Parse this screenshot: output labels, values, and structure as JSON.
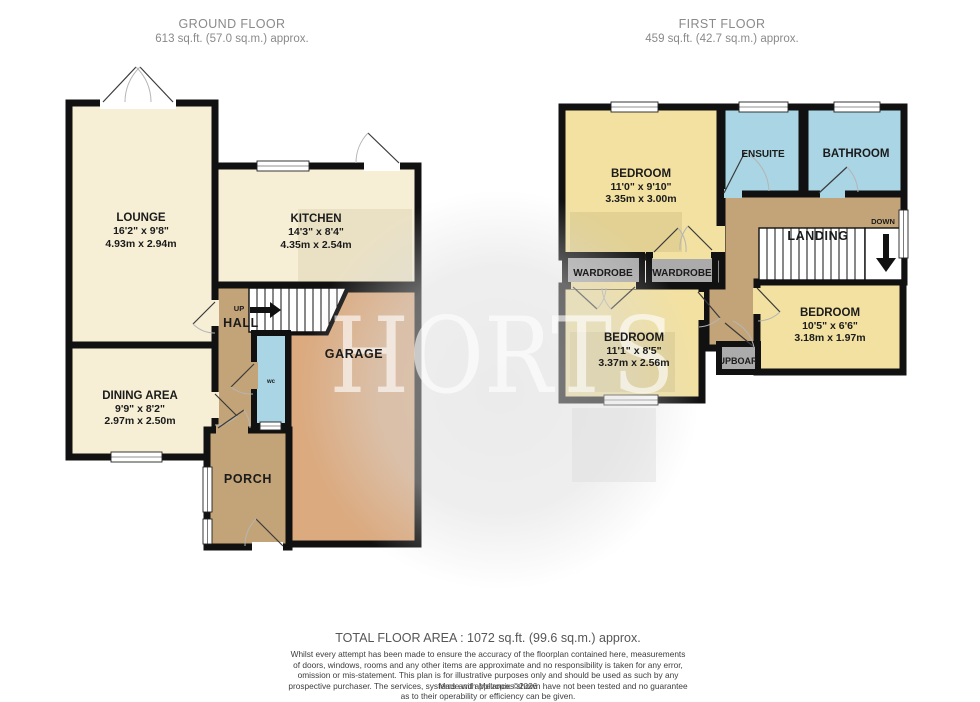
{
  "header": {
    "ground": {
      "title": "GROUND FLOOR",
      "area": "613 sq.ft. (57.0 sq.m.) approx."
    },
    "first": {
      "title": "FIRST FLOOR",
      "area": "459 sq.ft. (42.7 sq.m.) approx."
    }
  },
  "watermark": {
    "text": "HORTS"
  },
  "ground_floor": {
    "lounge": {
      "name": "LOUNGE",
      "dims_ft": "16'2\" x 9'8\"",
      "dims_m": "4.93m x 2.94m"
    },
    "kitchen": {
      "name": "KITCHEN",
      "dims_ft": "14'3\" x 8'4\"",
      "dims_m": "4.35m x 2.54m"
    },
    "dining": {
      "name": "DINING AREA",
      "dims_ft": "9'9\" x 8'2\"",
      "dims_m": "2.97m x 2.50m"
    },
    "hall": {
      "name": "HALL",
      "up": "UP"
    },
    "wc": {
      "name": "wc"
    },
    "porch": {
      "name": "PORCH"
    },
    "garage": {
      "name": "GARAGE"
    }
  },
  "first_floor": {
    "bedroom1": {
      "name": "BEDROOM",
      "dims_ft": "11'0\" x 9'10\"",
      "dims_m": "3.35m x 3.00m"
    },
    "bedroom2": {
      "name": "BEDROOM",
      "dims_ft": "11'1\" x 8'5\"",
      "dims_m": "3.37m x 2.56m"
    },
    "bedroom3": {
      "name": "BEDROOM",
      "dims_ft": "10'5\" x 6'6\"",
      "dims_m": "3.18m x 1.97m"
    },
    "ensuite": {
      "name": "ENSUITE"
    },
    "bathroom": {
      "name": "BATHROOM"
    },
    "wardrobe_left": {
      "name": "WARDROBE"
    },
    "wardrobe_right": {
      "name": "WARDROBE"
    },
    "landing": {
      "name": "LANDING",
      "down": "DOWN"
    },
    "cupboard": {
      "name": "CUPBOARD"
    }
  },
  "footer": {
    "total_area": "TOTAL FLOOR AREA : 1072 sq.ft. (99.6 sq.m.) approx.",
    "disclaimer": "Whilst every attempt has been made to ensure the accuracy of the floorplan contained here, measurements of doors, windows, rooms and any other items are approximate and no responsibility is taken for any error, omission or mis-statement. This plan is for illustrative purposes only and should be used as such by any prospective purchaser. The services, systems and appliances shown have not been tested and no guarantee as to their operability or efficiency can be given.",
    "credit": "Made with Metropix ©2026"
  },
  "palette": {
    "wall": "#111111",
    "cream": "#F6EFD6",
    "yellow": "#F2E1A1",
    "blue": "#A9D5E4",
    "brown": "#C3A478",
    "tan": "#DBAA7F",
    "gray": "#ABABAB",
    "label": "#1b1b1b",
    "muted": "#8a8a8a"
  }
}
